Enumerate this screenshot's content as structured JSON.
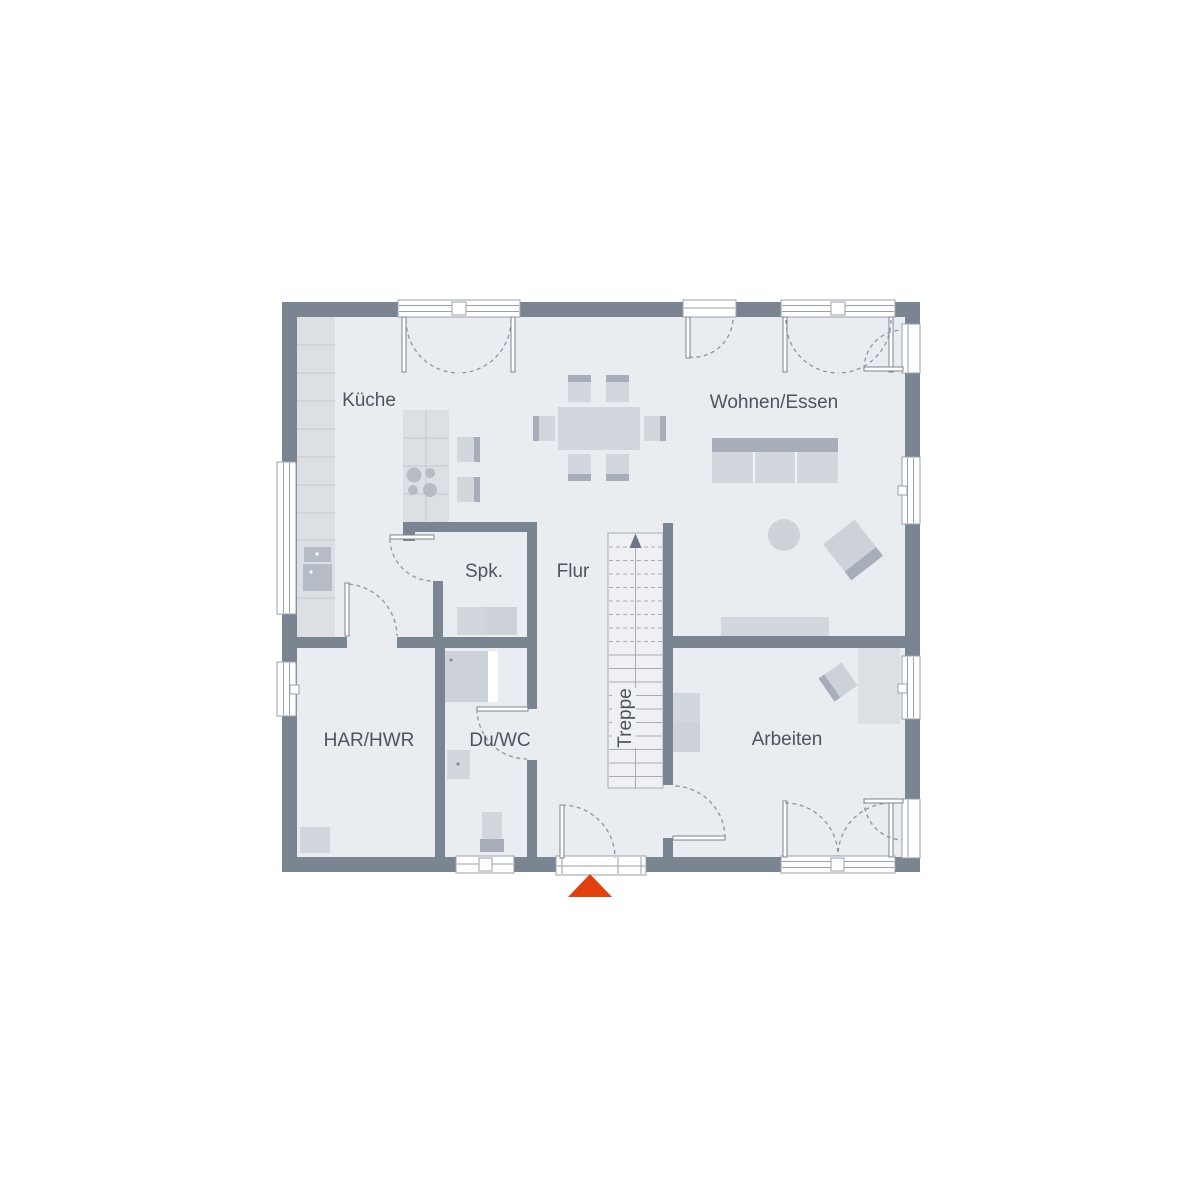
{
  "palette": {
    "background": "#ffffff",
    "wall": "#7b8491",
    "floor": "#e9ecf1",
    "floor_stairs": "#eef0f4",
    "furniture_light": "#d2d6dd",
    "furniture_mid": "#cdd2d9",
    "furniture_dark": "#a7aeb9",
    "counter": "#dcdfe4",
    "counter_line": "#c3c8cf",
    "appliance": "#b6bcc6",
    "frame_line": "#9aa1ad",
    "arc_line": "#8d95a1",
    "stair_line": "#a6adb9",
    "stair_arrow": "#6e7683",
    "text": "#4e545e",
    "entrance_marker": "#e2410f"
  },
  "rooms": {
    "kueche": {
      "label": "Küche"
    },
    "wohnen_essen": {
      "label": "Wohnen/Essen"
    },
    "spk": {
      "label": "Spk."
    },
    "flur": {
      "label": "Flur"
    },
    "treppe": {
      "label": "Treppe"
    },
    "har_hwr": {
      "label": "HAR/HWR"
    },
    "du_wc": {
      "label": "Du/WC"
    },
    "arbeiten": {
      "label": "Arbeiten"
    }
  }
}
